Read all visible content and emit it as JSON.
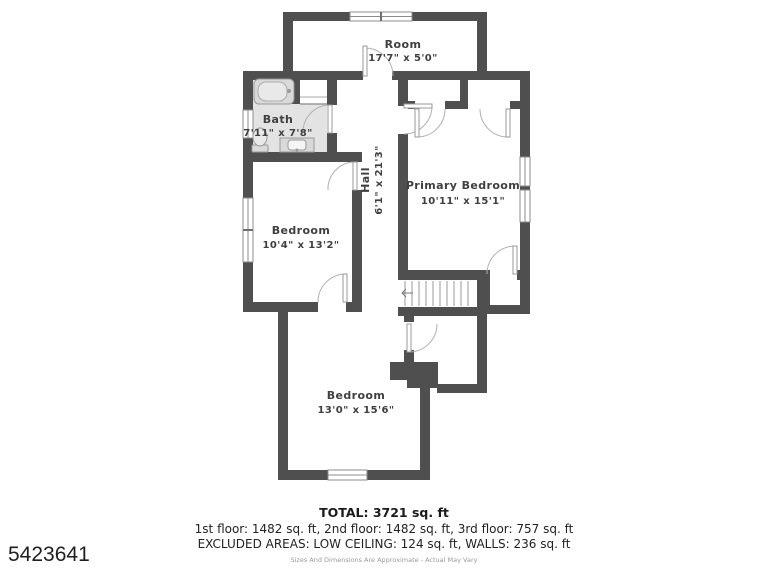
{
  "meta": {
    "listing_number": "5423641",
    "type": "floor-plan"
  },
  "rooms": {
    "top_room": {
      "name": "Room",
      "dims": "17'7\" x 5'0\""
    },
    "bath": {
      "name": "Bath",
      "dims": "7'11\" x 7'8\""
    },
    "hall": {
      "name": "Hall",
      "dims": "6'1\" x 21'3\""
    },
    "primary": {
      "name": "Primary Bedroom",
      "dims": "10'11\" x 15'1\""
    },
    "bedroom_left": {
      "name": "Bedroom",
      "dims": "10'4\" x 13'2\""
    },
    "bedroom_bottom": {
      "name": "Bedroom",
      "dims": "13'0\" x 15'6\""
    }
  },
  "summary": {
    "total": "TOTAL: 3721 sq. ft",
    "floors": "1st floor: 1482 sq. ft, 2nd floor: 1482 sq. ft, 3rd floor: 757 sq. ft",
    "excluded": "EXCLUDED AREAS: LOW CEILING: 124 sq. ft, WALLS: 236 sq. ft",
    "disclaimer": "Sizes And Dimensions Are Approximate - Actual May Vary"
  },
  "colors": {
    "wall": "#4f4f4f",
    "bath_floor": "#e3e3e3",
    "fixture_stroke": "#999999",
    "door_arc": "#b0b0b0",
    "label": "#3f3f3f"
  }
}
